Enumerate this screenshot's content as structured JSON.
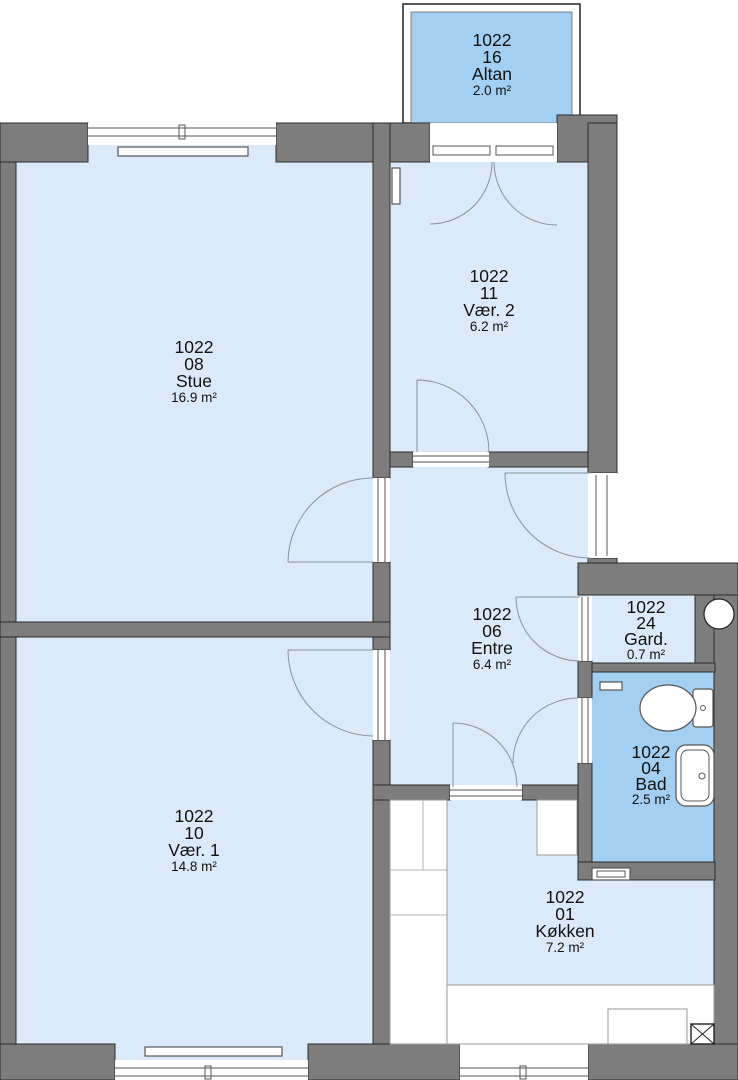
{
  "plan": {
    "unit_number": "1022",
    "rooms": [
      {
        "id": "16",
        "name": "Altan",
        "area": "2.0 m²"
      },
      {
        "id": "11",
        "name": "Vær. 2",
        "area": "6.2 m²"
      },
      {
        "id": "08",
        "name": "Stue",
        "area": "16.9 m²"
      },
      {
        "id": "06",
        "name": "Entre",
        "area": "6.4 m²"
      },
      {
        "id": "24",
        "name": "Gard.",
        "area": "0.7 m²"
      },
      {
        "id": "04",
        "name": "Bad",
        "area": "2.5 m²"
      },
      {
        "id": "10",
        "name": "Vær. 1",
        "area": "14.8 m²"
      },
      {
        "id": "01",
        "name": "Køkken",
        "area": "7.2 m²"
      }
    ],
    "colors": {
      "wall": "#7d7d7d",
      "outline": "#2b2b2b",
      "room_light": "#dbeafa",
      "room_accent": "#a3d0f2",
      "background": "#ffffff"
    },
    "fixtures": [
      "toilet",
      "sink",
      "radiator",
      "kitchen-counter",
      "duct-shaft",
      "column",
      "balcony-railing"
    ]
  }
}
